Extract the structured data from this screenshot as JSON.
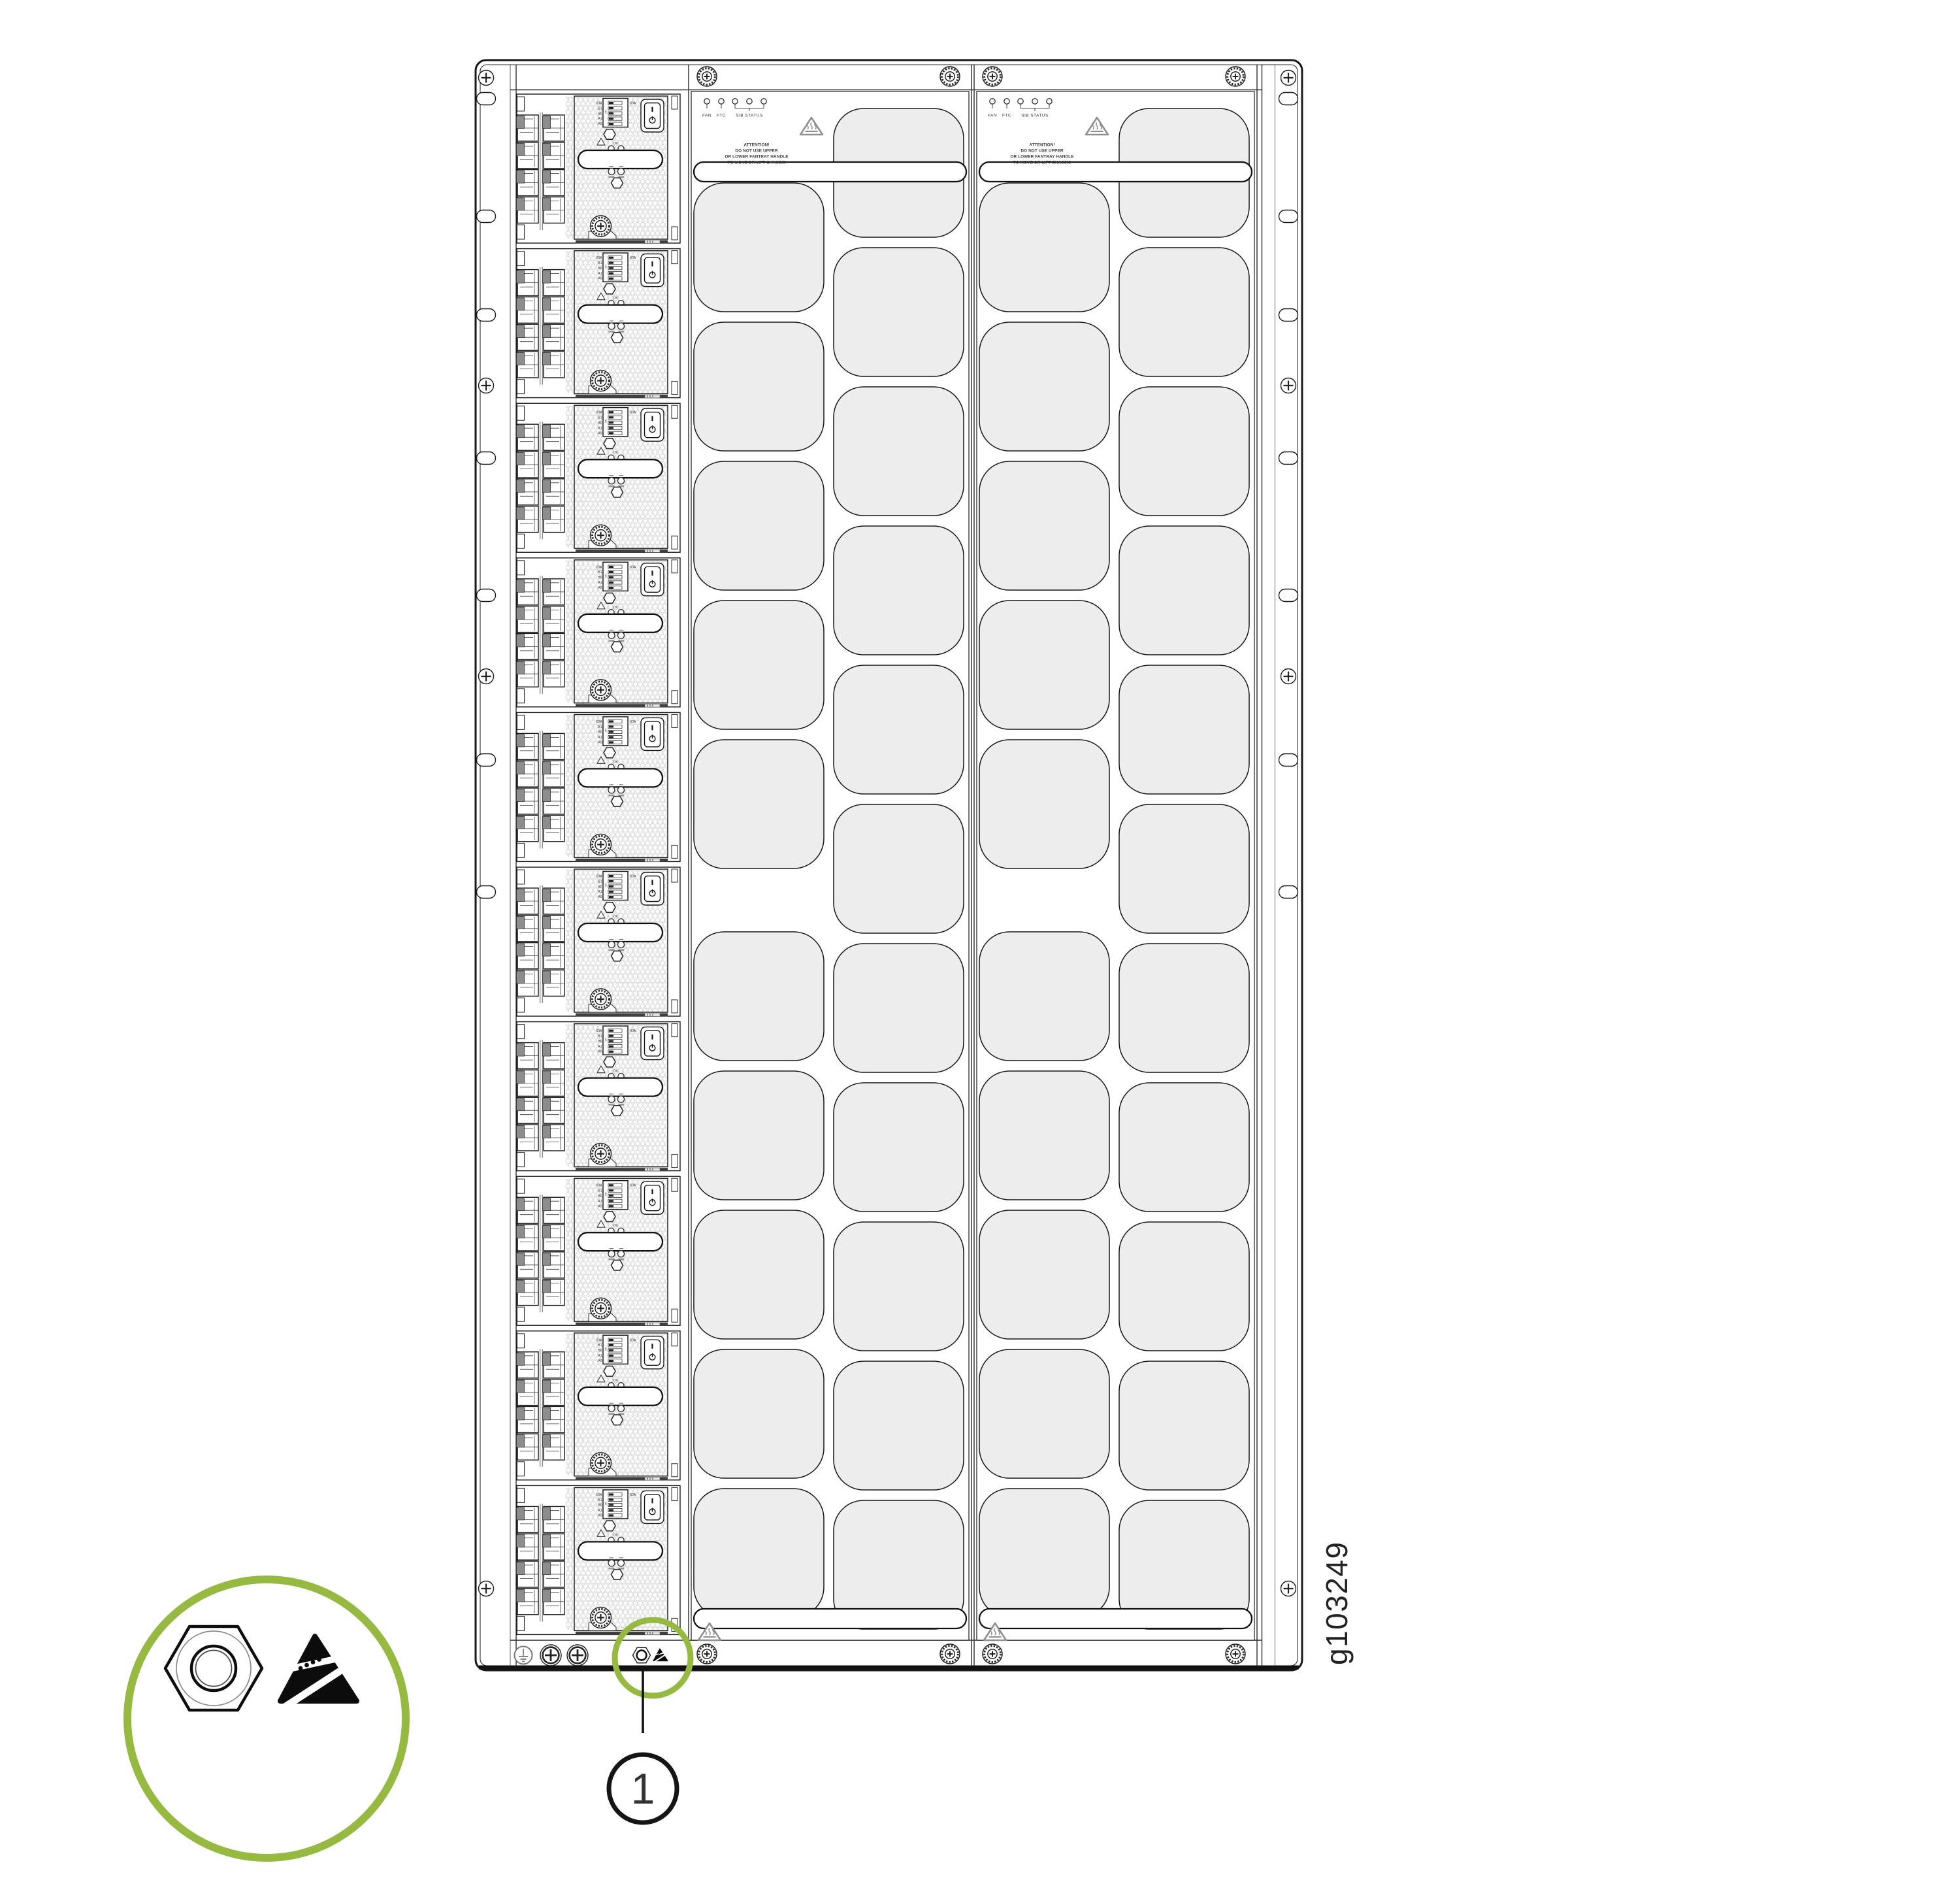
{
  "figure": {
    "code": "g103249",
    "callout_number": "1"
  },
  "colors": {
    "accent_green": "#96ba41",
    "cutout_fill": "#ededed",
    "latch_gray": "#8d8d8d",
    "line": "#161616"
  },
  "fan_tray": {
    "led_labels": [
      "FAN",
      "FTC",
      "SIB STATUS"
    ],
    "attention_lines": [
      "ATTENTION!",
      "DO NOT USE UPPER",
      "OR LOWER FANTRAY HANDLE",
      "TO MOVE OR LIFT CHASSIS"
    ]
  },
  "line_card": {
    "dip_labels": [
      "60A",
      "B1",
      "B0",
      "A1",
      "A0"
    ],
    "amp_label": "60A",
    "dip_on_label": "ON",
    "ok_label": "OK"
  }
}
